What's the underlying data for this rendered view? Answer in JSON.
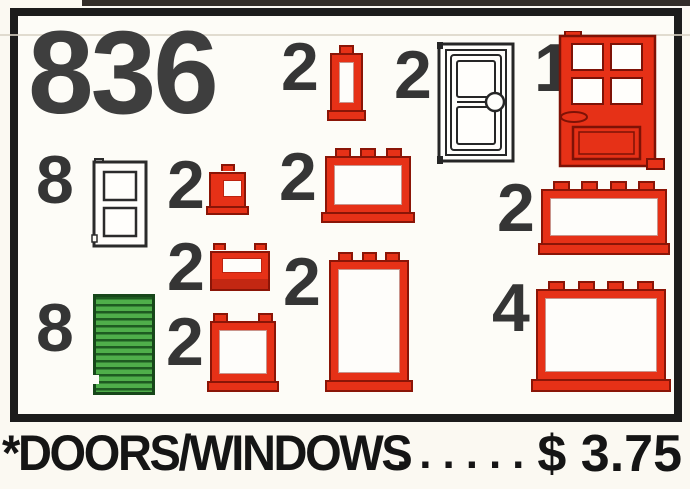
{
  "set_number": "836",
  "items": [
    {
      "qty": "2",
      "piece": "window-1x1x2-red"
    },
    {
      "qty": "2",
      "piece": "door-white-outline"
    },
    {
      "qty": "1",
      "piece": "door-4-pane-red"
    },
    {
      "qty": "8",
      "piece": "shutter-white-outline"
    },
    {
      "qty": "2",
      "piece": "window-1x1x1-red"
    },
    {
      "qty": "2",
      "piece": "window-1x3x2-red"
    },
    {
      "qty": "2",
      "piece": "window-1x4x2-red"
    },
    {
      "qty": "2",
      "piece": "window-slit-1x2x1-red"
    },
    {
      "qty": "2",
      "piece": "window-1x2x3-red"
    },
    {
      "qty": "8",
      "piece": "shutter-green"
    },
    {
      "qty": "2",
      "piece": "window-1x2x2-red"
    },
    {
      "qty": "4",
      "piece": "window-1x4x3-red"
    }
  ],
  "caption": {
    "label": "*DOORS/WINDOWS",
    "dots": "......",
    "price": "$ 3.75"
  },
  "colors": {
    "brick_red": "#e63117",
    "brick_red_outline": "#8a1507",
    "shutter_green": "#4fae4a",
    "number_ink": "#3e3e3e",
    "caption_ink": "#151515",
    "background": "#fbf9f2"
  }
}
